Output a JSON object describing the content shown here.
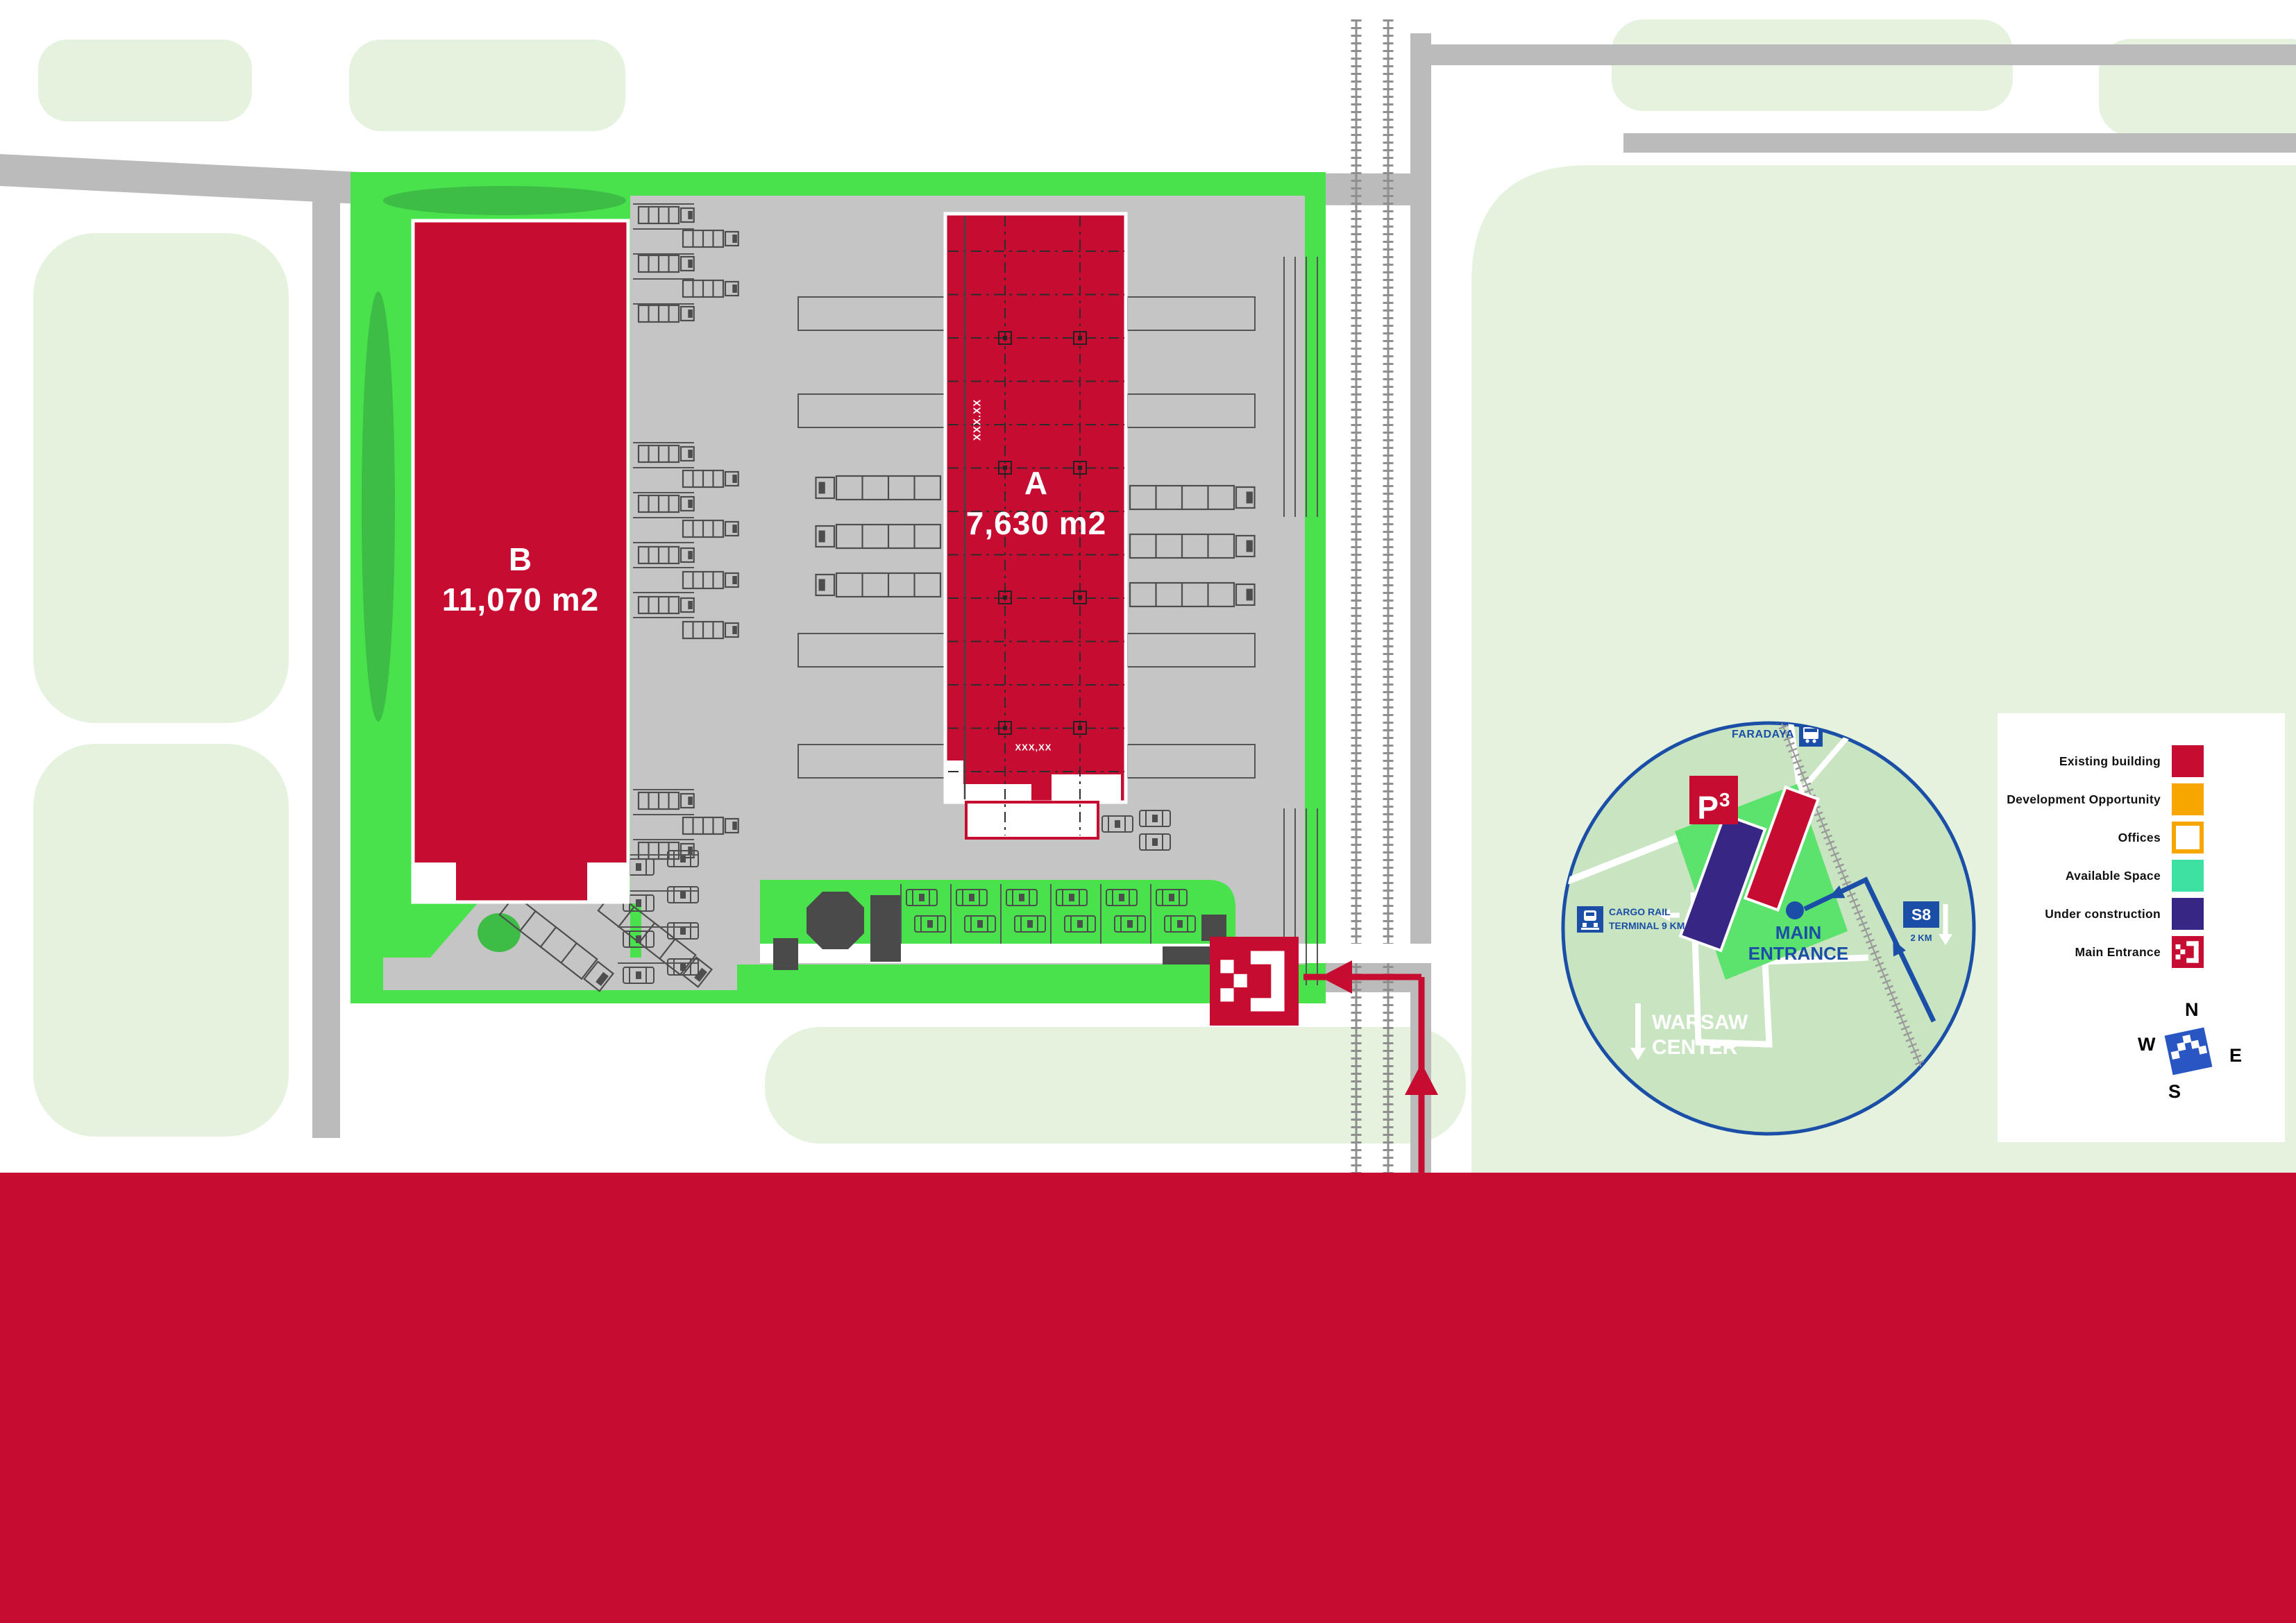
{
  "plan": {
    "building_a": {
      "label": "A",
      "area": "7,630 m2"
    },
    "building_b": {
      "label": "B",
      "area": "11,070 m2"
    },
    "dim_vertical": "XXX.XX",
    "dim_bottom": "XXX,XX"
  },
  "legend": {
    "items": [
      {
        "label": "Existing building",
        "type": "fill",
        "color": "#C60C30"
      },
      {
        "label": "Development Opportunity",
        "type": "fill",
        "color": "#F7A600"
      },
      {
        "label": "Offices",
        "type": "outline",
        "color": "#FFFFFF",
        "border": "#F7A600"
      },
      {
        "label": "Available Space",
        "type": "fill",
        "color": "#3DE2A2"
      },
      {
        "label": "Under construction",
        "type": "fill",
        "color": "#382685"
      },
      {
        "label": "Main Entrance",
        "type": "entrance",
        "color": "#C60C30"
      }
    ]
  },
  "compass": {
    "north": "N",
    "east": "E",
    "south": "S",
    "west": "W"
  },
  "minimap": {
    "station_label": "FARADAYA",
    "logo_text": "P",
    "logo_sup": "3",
    "entrance_line1": "MAIN",
    "entrance_line2": "ENTRANCE",
    "cargo_line1": "CARGO RAIL",
    "cargo_line2": "TERMINAL 9 KM",
    "motorway_badge": "S8",
    "motorway_distance": "2 KM",
    "city_line1": "WARSAW",
    "city_line2": "CENTER"
  },
  "colors": {
    "brand_red": "#C60C30",
    "orange": "#F7A600",
    "teal": "#3DE2A2",
    "purple": "#382685",
    "site_green": "#49E24D",
    "map_blue": "#1B4EA6"
  }
}
